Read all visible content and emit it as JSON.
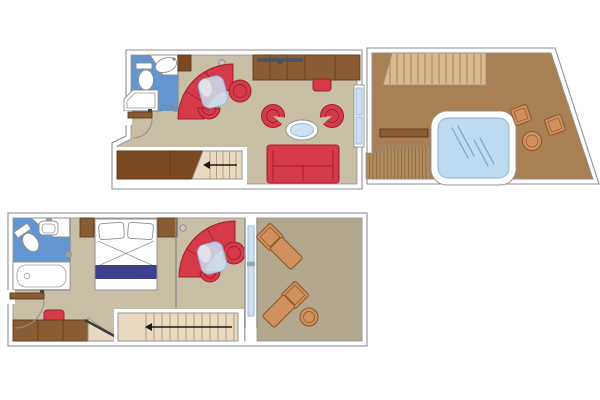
{
  "page": {
    "background": "#ffffff"
  },
  "colors": {
    "background": "#ffffff",
    "wall_white": "#ffffff",
    "outline": "#8f8f8f",
    "floor": "#c9bea6",
    "balcony_floor": "#b3a88d",
    "bathroom_blue": "#6396d1",
    "terrace_wood": "#a88053",
    "plank_light": "#d9ba8c",
    "plank_line": "#a9825a",
    "deck_dark": "#b18a5c",
    "deck_line": "#8a6740",
    "furniture_red": "#d63a49",
    "furniture_red_dark": "#9e1f2c",
    "wood_dark": "#7c4a22",
    "wood_mid": "#8a5c33",
    "wood_edge": "#5f3a1a",
    "steps": "#e9d9c1",
    "step_line": "#b49b7c",
    "glass": "#cde1f2",
    "glass_edge": "#94b8d6",
    "water": "#bddaf0",
    "water_edge": "#8fb2cc",
    "water_streak": "#7fa2bd",
    "bed_blue": "#3d3f8f",
    "rattan": "#d0915f",
    "rattan_edge": "#8a5526",
    "arrow": "#1a1a1a",
    "tv": "#4e555e",
    "fixture_gray": "#c9c9c9"
  },
  "floorplan": {
    "kind": "duplex-suite-floor-plan",
    "levels": [
      {
        "name": "upper-level",
        "rooms": [
          "bathroom",
          "living-room",
          "staircase",
          "terrace"
        ],
        "furniture": [
          "toilet",
          "washbasin",
          "shower",
          "corner-sofa",
          "glass-side-table",
          "armchair",
          "ottoman",
          "tub-chair-left",
          "tub-chair-right",
          "oval-coffee-table",
          "sofa",
          "sideboard",
          "tv",
          "stool",
          "wardrobe",
          "stairs-down-arrow",
          "whirlpool",
          "deck-stool",
          "deck-stool",
          "deck-round-table",
          "bench",
          "deck-steps",
          "boarding-planks"
        ]
      },
      {
        "name": "lower-level",
        "rooms": [
          "bathroom",
          "bedroom",
          "sitting-area",
          "staircase",
          "balcony"
        ],
        "furniture": [
          "toilet",
          "washbasin",
          "bathtub",
          "double-bed",
          "pillow",
          "pillow",
          "nightstand",
          "nightstand",
          "corner-sofa",
          "glass-side-table",
          "armchair",
          "ottoman",
          "desk-cabinet",
          "stool",
          "stairs-up-arrow",
          "sun-lounger",
          "sun-lounger",
          "balcony-round-table"
        ]
      }
    ]
  }
}
